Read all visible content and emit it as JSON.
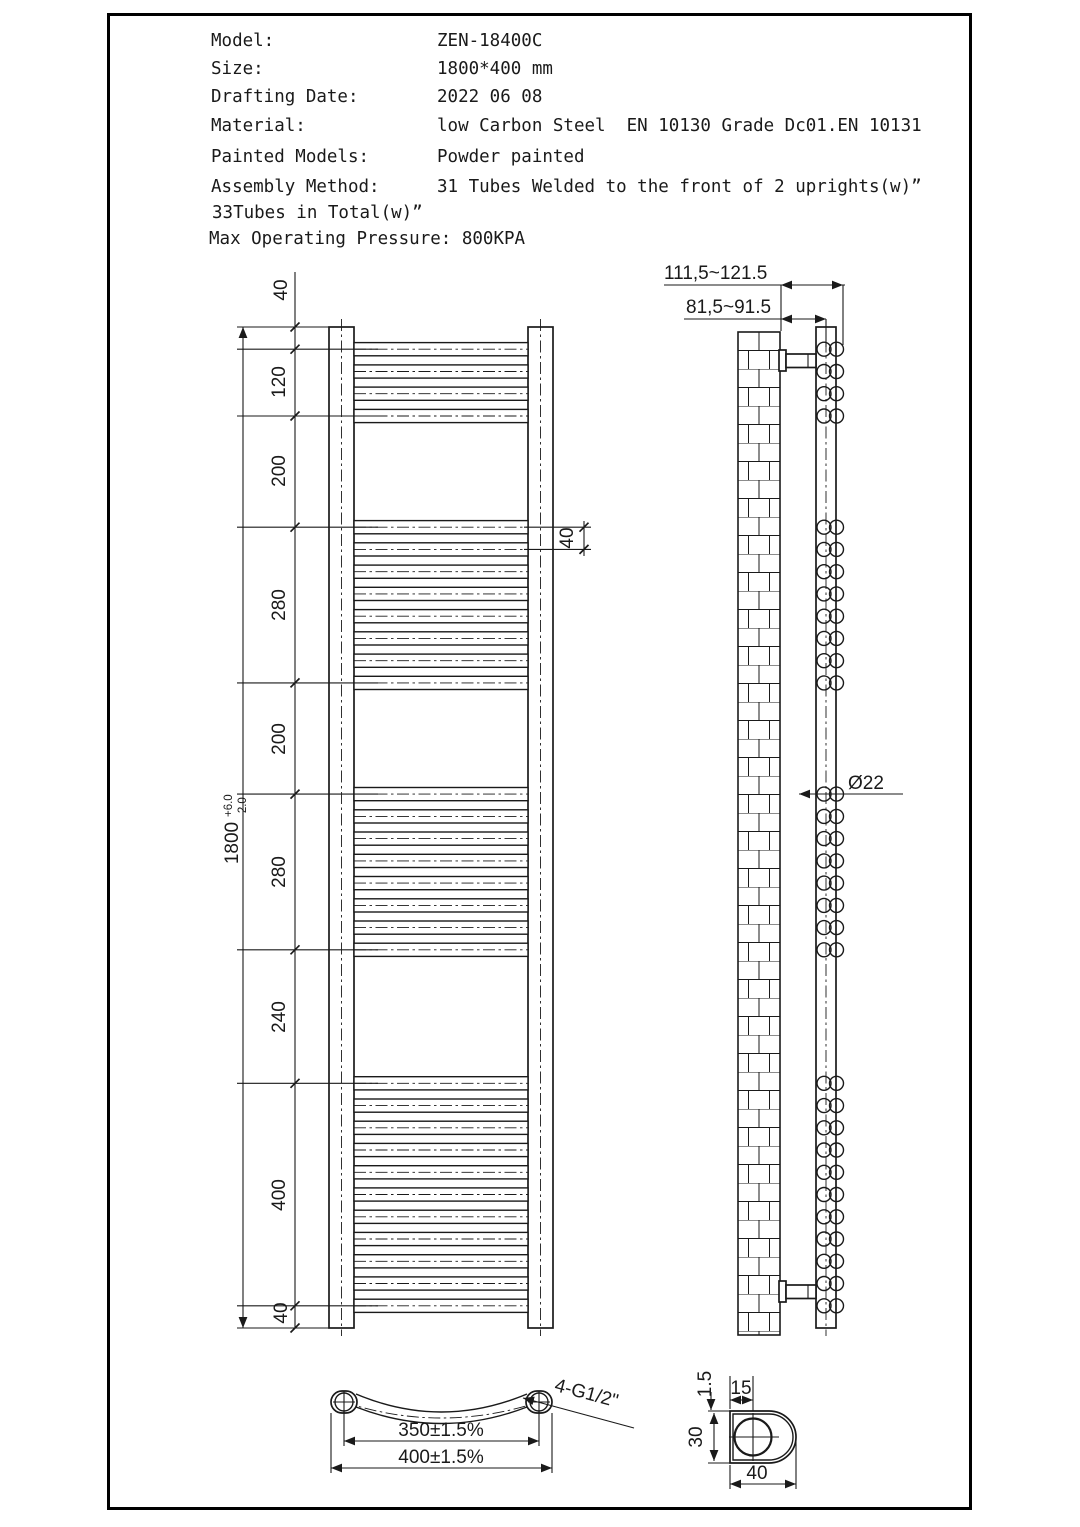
{
  "header": {
    "rows": [
      {
        "label": "Model:",
        "value": "ZEN-18400C"
      },
      {
        "label": "Size:",
        "value": "1800*400 mm"
      },
      {
        "label": "Drafting Date:",
        "value": "2022 06 08"
      },
      {
        "label": "Material:",
        "value": "low Carbon Steel  EN 10130 Grade Dc01.EN 10131"
      },
      {
        "label": "Painted Models:",
        "value": "Powder painted"
      },
      {
        "label": "Assembly Method:",
        "value": "31 Tubes Welded to the front of 2 uprights(w)”"
      }
    ],
    "line7": "33Tubes in Total(w)”",
    "line8": "Max Operating Pressure: 800KPA"
  },
  "front_view": {
    "dim_chain": [
      "40",
      "120",
      "200",
      "280",
      "200",
      "280",
      "240",
      "400",
      "40"
    ],
    "overall": {
      "value": "1800",
      "tol_plus": "+6.0",
      "tol_minus": "-2.0"
    },
    "pitch": "40"
  },
  "side_view": {
    "wall_to_front": "111,5~121.5",
    "wall_to_center": "81,5~91.5",
    "tube_diameter": "Ø22"
  },
  "bottom_view": {
    "centers_dim": "350±1.5%",
    "overall_dim": "400±1.5%",
    "thread_label": "4-G1/2\""
  },
  "section_view": {
    "wall_thickness": "1.5",
    "hole_offset": "15",
    "depth": "30",
    "width": "40"
  },
  "colors": {
    "line": "#1a1a1a",
    "background": "#ffffff"
  }
}
